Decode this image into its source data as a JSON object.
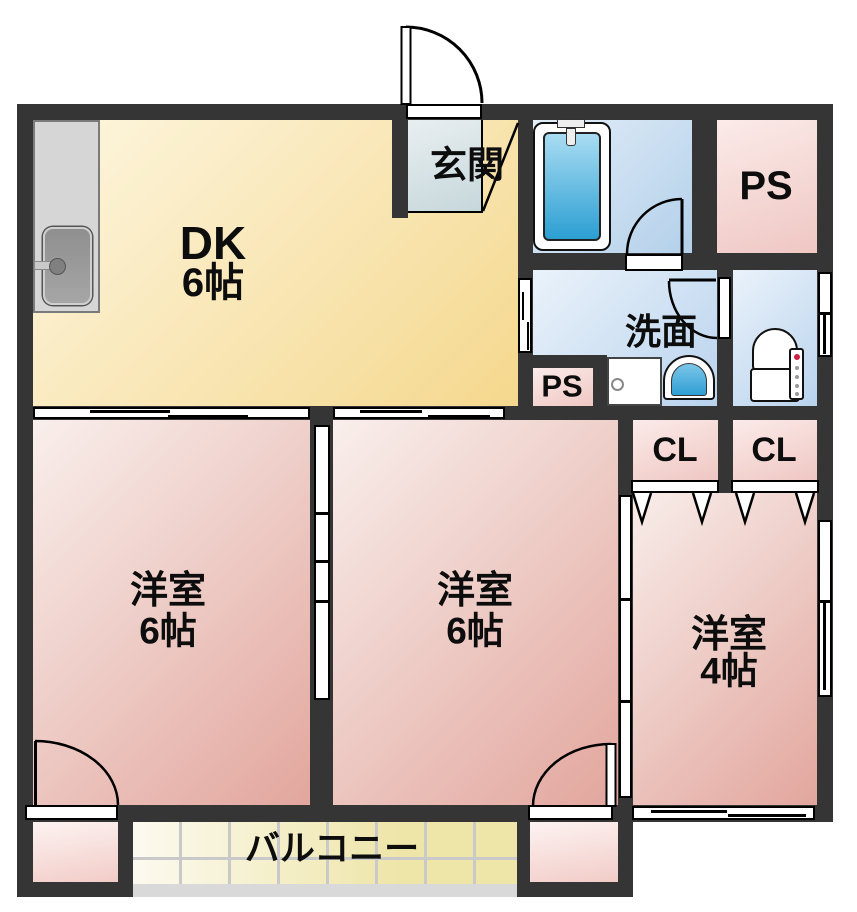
{
  "rooms": {
    "dk": {
      "name": "DK",
      "size": "6帖"
    },
    "genkan": {
      "label": "玄関"
    },
    "ps_top": {
      "label": "PS"
    },
    "washroom": {
      "label": "洗面"
    },
    "ps_small": {
      "label": "PS"
    },
    "closet_left": {
      "label": "CL"
    },
    "closet_right": {
      "label": "CL"
    },
    "bedroom_left": {
      "name": "洋室",
      "size": "6帖"
    },
    "bedroom_center": {
      "name": "洋室",
      "size": "6帖"
    },
    "bedroom_right": {
      "name": "洋室",
      "size": "4帖"
    },
    "balcony": {
      "label": "バルコニー"
    }
  },
  "fixtures": [
    "kitchen-sink",
    "bathtub",
    "washing-machine",
    "wash-basin",
    "toilet"
  ],
  "colors": {
    "wall": "#353535",
    "dk_light": "#fdf6e0",
    "dk_dark": "#f5d88e",
    "genkan_light": "#e9eff1",
    "genkan_dark": "#c6d7db",
    "room_light": "#f9efec",
    "room_dark": "#e2a69d",
    "ps_light": "#fbebe9",
    "ps_dark": "#efc7c3",
    "wet_light": "#eaf2fa",
    "wet_dark": "#b9d3ee",
    "bath_light": "#e3eef8",
    "bath_dark": "#b3d0ea",
    "tub_light": "#a9dcf2",
    "tub_dark": "#2b9fd2",
    "basin_light": "#7cc5e8",
    "basin_dark": "#2f9fd4",
    "alcove_light": "#fdf4f3",
    "alcove_dark": "#f2ccc7",
    "balcony_light": "#fcfaf0",
    "balcony_dark": "#eee5a8",
    "balcony_grid": "#c9c9c9",
    "rail": "#d9d9d9",
    "counter": "#d6d6d6",
    "sink": "#989898",
    "status_red": "#cc2244"
  }
}
